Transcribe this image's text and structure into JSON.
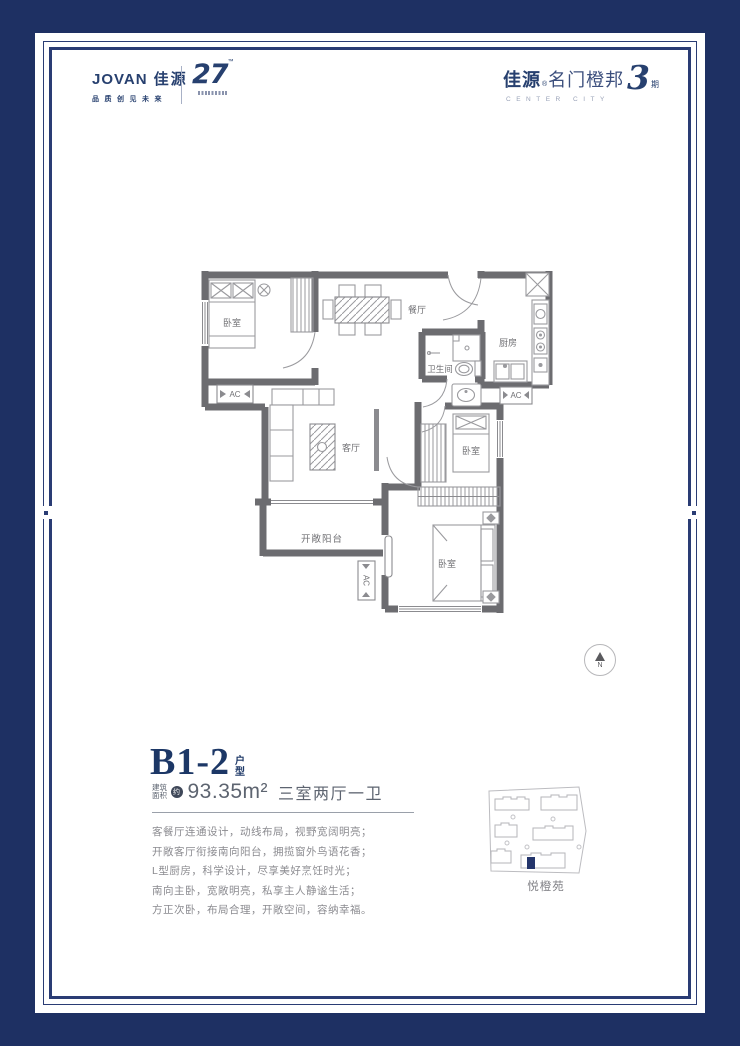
{
  "brand": {
    "left": {
      "wordmark_en": "JOVAN",
      "wordmark_cn": "佳源",
      "slogan": "品质创见未来",
      "anniversary": "27",
      "anniversary_tm": "™"
    },
    "right": {
      "name_cn": "佳源",
      "reg_mark": "®",
      "name_suffix": "名门橙邦",
      "name_en": "CENTER CITY",
      "phase_number": "3",
      "phase_unit": "期"
    }
  },
  "floorplan": {
    "rooms": {
      "bedroom1": "卧室",
      "dining": "餐厅",
      "kitchen": "厨房",
      "bathroom": "卫生间",
      "living": "客厅",
      "balcony": "开敞阳台",
      "bedroom2": "卧室",
      "bedroom3": "卧室"
    },
    "ac_label": "AC",
    "compass_n": "N"
  },
  "unit": {
    "title": "B1-2",
    "title_suffix": "户型",
    "area_label": "建筑面积",
    "area_approx": "约",
    "area_value": "93.35m²",
    "layout": "三室两厅一卫",
    "description": [
      "客餐厅连通设计，动线布局，视野宽阔明亮；",
      "开敞客厅衔接南向阳台，拥揽窗外鸟语花香；",
      "L型厨房，科学设计，尽享美好烹饪时光；",
      "南向主卧，宽敞明亮，私享主人静谧生活；",
      "方正次卧，布局合理，开敞空间，容纳幸福。"
    ]
  },
  "sitemap": {
    "label": "悦橙苑"
  },
  "colors": {
    "background_navy": "#1e3063",
    "border_navy": "#2a3c74",
    "brand_navy": "#27406f",
    "wall_gray": "#6c6c70",
    "furniture_gray": "#9a9a9e",
    "text_gray": "#8b8b90",
    "highlight_navy": "#24356b"
  }
}
